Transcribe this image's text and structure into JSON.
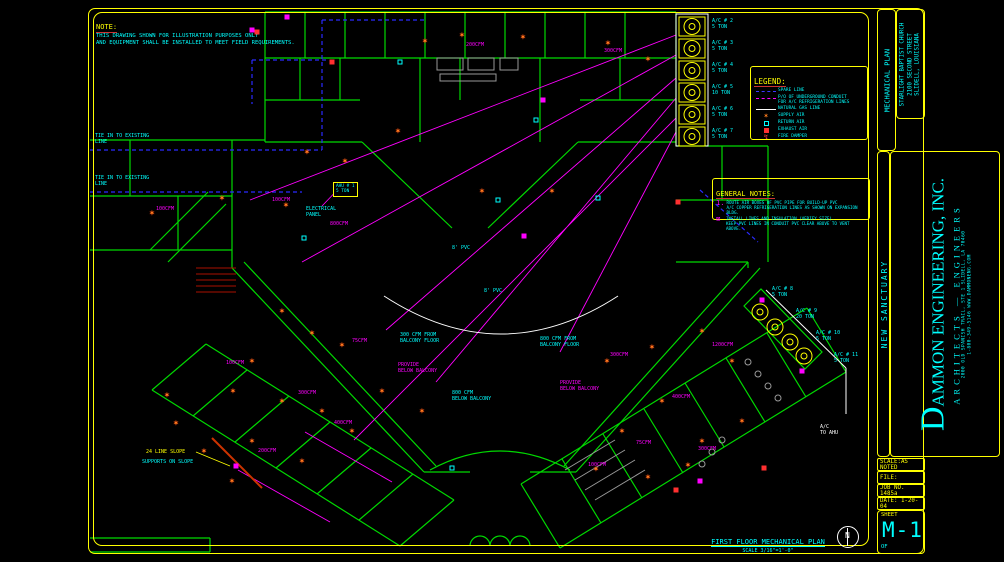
{
  "note": {
    "title": "NOTE:",
    "lines": [
      "THIS DRAWING SHOWN FOR ILLUSTRATION PURPOSES ONLY",
      "AND EQUIPMENT SHALL BE INSTALLED TO MEET FIELD REQUIREMENTS."
    ]
  },
  "legend": {
    "title": "LEGEND:",
    "items": [
      {
        "symbol": "spare-line-icon",
        "kind": "spare",
        "label": "SPARE LINE"
      },
      {
        "symbol": "refrigerant-line-icon",
        "kind": "refrig",
        "label": "P/O OF UNDERGROUND CONDUIT\nFOR A/C REFRIGERATION LINES"
      },
      {
        "symbol": "gas-line-icon",
        "kind": "gas",
        "label": "NATURAL GAS LINE"
      },
      {
        "symbol": "supply-air-icon",
        "kind": "star",
        "label": "SUPPLY AIR"
      },
      {
        "symbol": "return-air-icon",
        "kind": "return",
        "label": "RETURN AIR"
      },
      {
        "symbol": "exhaust-air-icon",
        "kind": "exhaust",
        "label": "EXHAUST AIR"
      },
      {
        "symbol": "fire-damper-icon",
        "kind": "damper",
        "label": "FIRE DAMPER"
      }
    ]
  },
  "general_notes": {
    "title": "GENERAL NOTES:",
    "items": [
      {
        "marker": "1.",
        "text": "ROUTE AIR BOXES OF PVC PIPE FOR BUILD-UP PVC\nA/C COPPER REFRIGERATION LINES AS SHOWN ON EXPANSION BLDG."
      },
      {
        "marker": "⊠",
        "text": "INSTALL LINES AND INSULATION (VERIFY SIZE).\nKEEP PVC LINES IN CONDUIT PVC CLEAR ABOVE TO VENT ABOVE."
      }
    ]
  },
  "plan_title": {
    "text": "FIRST FLOOR MECHANICAL PLAN",
    "scale": "SCALE 3/16\"=1'-0\""
  },
  "north_label": "N",
  "title_block": {
    "discipline": "MECHANICAL PLAN",
    "client_lines": [
      "STARLIGHT BAPTIST CHURCH",
      "2100 SECOND STREET",
      "SLIDELL, LOUISIANA"
    ],
    "project": "NEW SANCTUARY",
    "firm_initial": "D",
    "firm_rest": "AMMON ENGINEERING, INC.",
    "firm_sub": "ARCHITECTS — ENGINEERS",
    "firm_address": "2000 OLD SPANISH TRAIL, STE 1   SLIDELL, LA 70460",
    "firm_contact": "1-800-349-5146   WWW.DAMMONENG.COM",
    "rows": {
      "scale": "SCALE:AS NOTED",
      "file": "FILE:",
      "job": "JOB NO. 1485a",
      "date": "DATE: 1-20-04"
    },
    "sheet_label": "SHEET",
    "sheet_number": "M-1",
    "of_label": "OF"
  },
  "plan": {
    "labels": [
      {
        "x": 95,
        "y": 133,
        "t": "TIE IN TO EXISTING\nLINE",
        "c": "cy"
      },
      {
        "x": 95,
        "y": 175,
        "t": "TIE IN TO EXISTING\nLINE",
        "c": "cy"
      },
      {
        "x": 452,
        "y": 245,
        "t": "8' PVC",
        "c": "cy"
      },
      {
        "x": 484,
        "y": 288,
        "t": "8' PVC",
        "c": "cy"
      },
      {
        "x": 400,
        "y": 332,
        "t": "300 CFM FROM\nBALCONY FLOOR",
        "c": "cy"
      },
      {
        "x": 540,
        "y": 336,
        "t": "800 CFM FROM\nBALCONY FLOOR",
        "c": "cy"
      },
      {
        "x": 398,
        "y": 362,
        "t": "PROVIDE\nBELOW BALCONY",
        "c": "mg"
      },
      {
        "x": 560,
        "y": 380,
        "t": "PROVIDE\nBELOW BALCONY",
        "c": "mg"
      },
      {
        "x": 452,
        "y": 390,
        "t": "800 CFM\nBELOW BALCONY",
        "c": "cy"
      },
      {
        "x": 306,
        "y": 206,
        "t": "ELECTRICAL\nPANEL",
        "c": "cy"
      },
      {
        "x": 146,
        "y": 449,
        "t": "24 LINE SLOPE",
        "c": "yl"
      },
      {
        "x": 142,
        "y": 459,
        "t": "SUPPORTS ON SLOPE",
        "c": "cy"
      },
      {
        "x": 820,
        "y": 424,
        "t": "A/C\nTO AHU",
        "c": "wh"
      },
      {
        "x": 272,
        "y": 197,
        "t": "100CFM",
        "c": "mg"
      },
      {
        "x": 330,
        "y": 221,
        "t": "800CFM",
        "c": "mg"
      },
      {
        "x": 352,
        "y": 338,
        "t": "75CFM",
        "c": "mg"
      },
      {
        "x": 298,
        "y": 390,
        "t": "300CFM",
        "c": "mg"
      },
      {
        "x": 334,
        "y": 420,
        "t": "400CFM",
        "c": "mg"
      },
      {
        "x": 258,
        "y": 448,
        "t": "200CFM",
        "c": "mg"
      },
      {
        "x": 610,
        "y": 352,
        "t": "300CFM",
        "c": "mg"
      },
      {
        "x": 672,
        "y": 394,
        "t": "400CFM",
        "c": "mg"
      },
      {
        "x": 636,
        "y": 440,
        "t": "75CFM",
        "c": "mg"
      },
      {
        "x": 712,
        "y": 342,
        "t": "1200CFM",
        "c": "mg"
      },
      {
        "x": 588,
        "y": 462,
        "t": "100CFM",
        "c": "mg"
      },
      {
        "x": 226,
        "y": 360,
        "t": "100CFM",
        "c": "mg"
      },
      {
        "x": 466,
        "y": 42,
        "t": "200CFM",
        "c": "mg"
      },
      {
        "x": 604,
        "y": 48,
        "t": "300CFM",
        "c": "mg"
      },
      {
        "x": 156,
        "y": 206,
        "t": "100CFM",
        "c": "mg"
      },
      {
        "x": 698,
        "y": 446,
        "t": "300CFM",
        "c": "mg"
      },
      {
        "x": 712,
        "y": 18,
        "t": "A/C # 2\n5 TON",
        "c": "cy"
      },
      {
        "x": 712,
        "y": 40,
        "t": "A/C # 3\n5 TON",
        "c": "cy"
      },
      {
        "x": 712,
        "y": 62,
        "t": "A/C # 4\n5 TON",
        "c": "cy"
      },
      {
        "x": 712,
        "y": 84,
        "t": "A/C # 5\n10 TON",
        "c": "cy"
      },
      {
        "x": 712,
        "y": 106,
        "t": "A/C # 6\n5 TON",
        "c": "cy"
      },
      {
        "x": 712,
        "y": 128,
        "t": "A/C # 7\n5 TON",
        "c": "cy"
      },
      {
        "x": 772,
        "y": 286,
        "t": "A/C # 8\n5 TON",
        "c": "cy"
      },
      {
        "x": 796,
        "y": 308,
        "t": "A/C # 9\n20 TON",
        "c": "cy"
      },
      {
        "x": 816,
        "y": 330,
        "t": "A/C # 10\n5 TON",
        "c": "cy"
      },
      {
        "x": 834,
        "y": 352,
        "t": "A/C # 11\n5 TON",
        "c": "cy"
      }
    ],
    "ahu_boxes": [
      {
        "x": 333,
        "y": 182,
        "t": "AHU # 1\n5 TON"
      }
    ],
    "diffusers": [
      [
        152,
        214
      ],
      [
        222,
        199
      ],
      [
        286,
        206
      ],
      [
        307,
        153
      ],
      [
        345,
        162
      ],
      [
        425,
        42
      ],
      [
        462,
        36
      ],
      [
        523,
        38
      ],
      [
        398,
        132
      ],
      [
        608,
        44
      ],
      [
        648,
        60
      ],
      [
        282,
        312
      ],
      [
        312,
        334
      ],
      [
        252,
        362
      ],
      [
        233,
        392
      ],
      [
        282,
        402
      ],
      [
        322,
        412
      ],
      [
        352,
        432
      ],
      [
        302,
        462
      ],
      [
        252,
        442
      ],
      [
        382,
        392
      ],
      [
        422,
        412
      ],
      [
        167,
        396
      ],
      [
        342,
        346
      ],
      [
        607,
        362
      ],
      [
        652,
        348
      ],
      [
        702,
        332
      ],
      [
        732,
        362
      ],
      [
        662,
        402
      ],
      [
        622,
        432
      ],
      [
        702,
        442
      ],
      [
        742,
        422
      ],
      [
        482,
        192
      ],
      [
        552,
        192
      ],
      [
        176,
        424
      ],
      [
        204,
        452
      ],
      [
        232,
        482
      ],
      [
        648,
        478
      ],
      [
        688,
        466
      ],
      [
        596,
        470
      ]
    ],
    "returns": [
      [
        400,
        62
      ],
      [
        498,
        200
      ],
      [
        304,
        238
      ],
      [
        598,
        198
      ],
      [
        452,
        468
      ],
      [
        536,
        120
      ]
    ],
    "exhausts": [
      [
        332,
        62
      ],
      [
        678,
        202
      ],
      [
        764,
        468
      ],
      [
        676,
        490
      ],
      [
        257,
        32
      ]
    ],
    "dampers": [
      [
        252,
        30
      ],
      [
        287,
        17
      ],
      [
        543,
        100
      ],
      [
        236,
        466
      ],
      [
        700,
        481
      ],
      [
        762,
        300
      ],
      [
        802,
        371
      ],
      [
        524,
        236
      ]
    ]
  },
  "colors": {
    "wall_green": "#00d900",
    "text_cyan": "#00ffff",
    "accent_yellow": "#ffff00",
    "duct_magenta": "#ff00ff",
    "spare_blue": "#2a2aff",
    "gas_white": "#ffffff",
    "diffuser_orange": "#ff7f1f",
    "exhaust_red": "#ff3030"
  }
}
